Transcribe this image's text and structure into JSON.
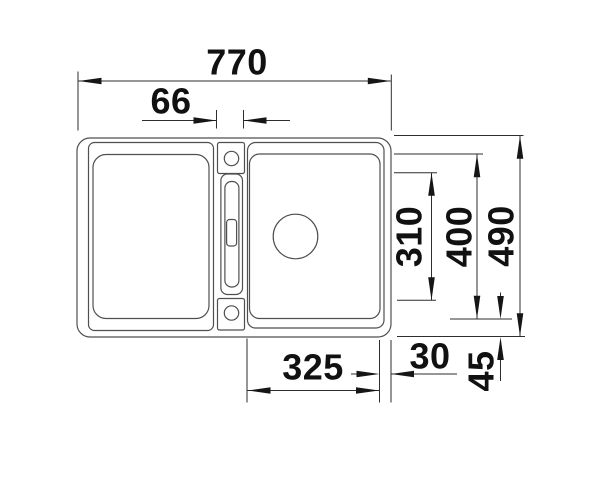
{
  "drawing": {
    "description": "Technical top-view dimension drawing of a kitchen sink: left bowl, center tap ledge with tap hole, overflow slot and lower hole, right bowl with round drain",
    "colors": {
      "background": "#ffffff",
      "sink_outline": "#4f4f4f",
      "dimension_line": "#2e2e2e",
      "arrow_and_text": "#111111"
    },
    "dimensions": {
      "overall_width": "770",
      "tap_ledge_width": "66",
      "right_inner_height": "310",
      "bowl_height": "400",
      "overall_height": "490",
      "bowl_width": "325",
      "right_edge_offset": "30",
      "bottom_edge_offset": "45"
    }
  }
}
